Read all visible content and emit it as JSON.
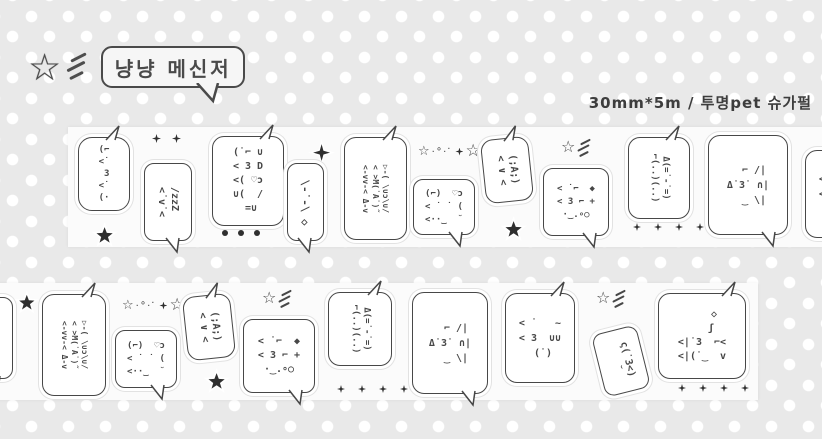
{
  "colors": {
    "background": "#e9e9e9",
    "dot": "#ffffff",
    "tape": "#fbfbfb",
    "ink": "#474747"
  },
  "logo": {
    "star_char": "☆",
    "text": "냥냥 메신저"
  },
  "header": {
    "size_text": "30mm*5m / 투명pet 슈가펄"
  },
  "strips": [
    {
      "id": "tape-strip-top",
      "x": 68,
      "y": 127,
      "w": 754,
      "h": 120,
      "items": [
        {
          "kind": "bubble",
          "name": "sticker-kiss-cat",
          "x": 10,
          "y": 10,
          "w": 50,
          "h": 72,
          "r": 14,
          "tail": "tr",
          "fs": 9,
          "lh": 12,
          "lines": [
            "(⌐",
            "<˙",
            " 3",
            "<˙",
            "(·"
          ]
        },
        {
          "kind": "star5",
          "name": "black-star-icon",
          "x": 23,
          "y": 95,
          "size": 17
        },
        {
          "kind": "sparks",
          "name": "sparkle-pair-icon",
          "x": 84,
          "y": 7,
          "n": 2,
          "size": 9,
          "gap": 11
        },
        {
          "kind": "bubble",
          "name": "sticker-sleepy-cat",
          "x": 76,
          "y": 36,
          "w": 46,
          "h": 76,
          "r": 10,
          "tail": "br",
          "rot": 90,
          "fs": 10,
          "lh": 13,
          "lines": [
            "/zzZ ",
            "<˙v˙<"
          ]
        },
        {
          "kind": "bubble",
          "name": "sticker-tongue-cat",
          "x": 144,
          "y": 9,
          "w": 70,
          "h": 88,
          "r": 12,
          "tail": "tr",
          "fs": 10,
          "lh": 14,
          "lines": [
            "(˙⌐ ∪",
            "< 3 D",
            "<( ♡ɔ",
            "∪(  /",
            " =∪"
          ]
        },
        {
          "kind": "dots",
          "name": "dot-row-icon",
          "x": 154,
          "y": 103,
          "n": 3,
          "size": 6,
          "gap": 10
        },
        {
          "kind": "star4",
          "name": "black-sparkle-icon",
          "x": 240,
          "y": 12,
          "size": 17
        },
        {
          "kind": "bubble",
          "name": "sticker-shy-cat",
          "x": 219,
          "y": 36,
          "w": 35,
          "h": 76,
          "r": 10,
          "tail": "br",
          "rot": 90,
          "fs": 11,
          "lh": 13,
          "lines": [
            "\\-˙-\\ ◇"
          ]
        },
        {
          "kind": "bubble",
          "name": "sticker-chat-cats",
          "x": 276,
          "y": 10,
          "w": 61,
          "h": 101,
          "r": 12,
          "tail": "tr",
          "rot": 90,
          "fs": 8,
          "lh": 10,
          "lines": [
            "▷-( \\∪ɔ\\∪/",
            "< >M(˙A˙)˝",
            "<-vv-< Δ-v"
          ]
        },
        {
          "kind": "stardust",
          "name": "star-trail-icon",
          "x": 350,
          "y": 16,
          "left": "☆",
          "trail": ".∘.·",
          "right": "☆"
        },
        {
          "kind": "bubble",
          "name": "sticker-heart-cat",
          "x": 345,
          "y": 52,
          "w": 60,
          "h": 54,
          "r": 10,
          "tail": "br",
          "fs": 9,
          "lh": 13,
          "lines": [
            "(⌐)  ♡ɔ",
            "< ˙ ˙ (",
            "<··‿  ˘"
          ]
        },
        {
          "kind": "bubble",
          "name": "sticker-cry-cat",
          "x": 415,
          "y": 11,
          "w": 46,
          "h": 62,
          "r": 12,
          "tail": "tr",
          "rot": 90,
          "tilt": -6,
          "fs": 10,
          "lh": 12,
          "lines": [
            "(;A;)",
            "< ∨ <"
          ]
        },
        {
          "kind": "star5",
          "name": "black-star-icon",
          "x": 432,
          "y": 89,
          "size": 17
        },
        {
          "kind": "bubble",
          "name": "sticker-bubble-blowing-cat",
          "x": 475,
          "y": 41,
          "w": 64,
          "h": 66,
          "r": 10,
          "tail": "br",
          "fs": 9,
          "lh": 13,
          "lines": [
            "< ˙⌐  ◆",
            "< 3 ⌐ +",
            "·‿.∘○"
          ]
        },
        {
          "kind": "starlines",
          "name": "shooting-star-icon",
          "x": 493,
          "y": 12,
          "star": "☆"
        },
        {
          "kind": "bubble",
          "name": "sticker-twin-cats",
          "x": 560,
          "y": 10,
          "w": 60,
          "h": 80,
          "r": 12,
          "tail": "tr",
          "rot": 90,
          "fs": 9,
          "lh": 11,
          "lines": [
            "Δ(=˙-˙=)",
            "⌐(..)(..)"
          ]
        },
        {
          "kind": "sparks",
          "name": "dot-row-icon",
          "x": 565,
          "y": 96,
          "n": 4,
          "size": 8,
          "gap": 13
        },
        {
          "kind": "bubble",
          "name": "sticker-book-cat",
          "x": 640,
          "y": 8,
          "w": 78,
          "h": 98,
          "r": 12,
          "tail": "br",
          "fs": 10,
          "lh": 15,
          "lines": [
            "  ⌐ /|",
            "Δ˙3˙ ∩|",
            "  ‿ \\|"
          ]
        },
        {
          "kind": "bubble",
          "name": "sticker-kiss-uu-cat",
          "x": 737,
          "y": 23,
          "w": 68,
          "h": 86,
          "r": 12,
          "tail": "tr",
          "fs": 10,
          "lh": 15,
          "lines": [
            "< ˙   ~",
            "< 3  ∪∪",
            " (˙)"
          ]
        }
      ]
    },
    {
      "id": "tape-strip-bottom",
      "x": -40,
      "y": 283,
      "w": 798,
      "h": 117,
      "items": [
        {
          "kind": "bubble",
          "name": "sticker-shy-cat",
          "x": 16,
          "y": 14,
          "w": 35,
          "h": 80,
          "r": 10,
          "tail": "br",
          "rot": 90,
          "fs": 11,
          "lh": 13,
          "lines": [
            "\\-˙-\\ ◇"
          ]
        },
        {
          "kind": "star5",
          "name": "black-star-icon",
          "x": 54,
          "y": 7,
          "size": 16
        },
        {
          "kind": "bubble",
          "name": "sticker-chat-cats",
          "x": 82,
          "y": 11,
          "w": 62,
          "h": 100,
          "r": 12,
          "tail": "tr",
          "rot": 90,
          "fs": 8,
          "lh": 10,
          "lines": [
            "▷-( \\∪ɔ\\∪/",
            "< >M(˙A˙)˝",
            "<-vv-< Δ-v"
          ]
        },
        {
          "kind": "stardust",
          "name": "star-trail-icon",
          "x": 162,
          "y": 14,
          "left": "☆",
          "trail": ".∘.·",
          "right": "☆"
        },
        {
          "kind": "bubble",
          "name": "sticker-heart-cat",
          "x": 155,
          "y": 47,
          "w": 60,
          "h": 56,
          "r": 10,
          "tail": "br",
          "fs": 9,
          "lh": 13,
          "lines": [
            "(⌐)  ♡ɔ",
            "< ˙ ˙ (",
            "<··‿  ˘"
          ]
        },
        {
          "kind": "bubble",
          "name": "sticker-cry-cat",
          "x": 225,
          "y": 12,
          "w": 46,
          "h": 62,
          "r": 12,
          "tail": "tr",
          "rot": 90,
          "tilt": -6,
          "fs": 10,
          "lh": 12,
          "lines": [
            "(;A;)",
            "< ∨ <"
          ]
        },
        {
          "kind": "starlines",
          "name": "shooting-star-icon",
          "x": 302,
          "y": 7,
          "star": "☆"
        },
        {
          "kind": "bubble",
          "name": "sticker-bubble-blowing-cat",
          "x": 283,
          "y": 36,
          "w": 70,
          "h": 72,
          "r": 10,
          "tail": "br",
          "fs": 10,
          "lh": 14,
          "lines": [
            "< ˙⌐  ◆",
            "< 3 ⌐ +",
            "·‿.∘○"
          ]
        },
        {
          "kind": "star5",
          "name": "black-star-icon",
          "x": 243,
          "y": 85,
          "size": 17
        },
        {
          "kind": "bubble",
          "name": "sticker-twin-cats",
          "x": 368,
          "y": 9,
          "w": 62,
          "h": 72,
          "r": 12,
          "tail": "tr",
          "rot": 90,
          "fs": 9,
          "lh": 11,
          "lines": [
            "Δ(=˙-˙=)",
            "⌐(..)(..)"
          ]
        },
        {
          "kind": "sparks",
          "name": "dot-row-icon",
          "x": 377,
          "y": 102,
          "n": 4,
          "size": 8,
          "gap": 13
        },
        {
          "kind": "bubble",
          "name": "sticker-book-cat",
          "x": 452,
          "y": 9,
          "w": 74,
          "h": 100,
          "r": 12,
          "tail": "br",
          "fs": 10,
          "lh": 15,
          "lines": [
            "  ⌐ /|",
            "Δ˙3˙ ∩|",
            "  ‿ \\|"
          ]
        },
        {
          "kind": "bubble",
          "name": "sticker-kiss-uu-cat",
          "x": 545,
          "y": 10,
          "w": 68,
          "h": 88,
          "r": 12,
          "tail": "tr",
          "fs": 10,
          "lh": 15,
          "lines": [
            "< ˙   ~",
            "< 3  ∪∪",
            " (˙)"
          ]
        },
        {
          "kind": "starlines",
          "name": "shooting-star-icon",
          "x": 636,
          "y": 7,
          "star": "☆"
        },
        {
          "kind": "bubble",
          "name": "sticker-tilted-cat",
          "x": 638,
          "y": 46,
          "w": 44,
          "h": 62,
          "r": 10,
          "rot": 90,
          "tilt": -14,
          "fs": 10,
          "lh": 12,
          "lines": [
            "ς(˙3<)",
            "  ˘"
          ]
        },
        {
          "kind": "bubble",
          "name": "sticker-wink-cat",
          "x": 698,
          "y": 10,
          "w": 86,
          "h": 84,
          "r": 12,
          "tail": "tr",
          "fs": 10,
          "lh": 14,
          "lines": [
            "    ◇",
            "   ʃ",
            "<|˙3  ⌐<",
            "<|(˙‿  v"
          ]
        },
        {
          "kind": "sparks",
          "name": "dot-row-icon",
          "x": 718,
          "y": 101,
          "n": 4,
          "size": 8,
          "gap": 13
        }
      ]
    }
  ]
}
